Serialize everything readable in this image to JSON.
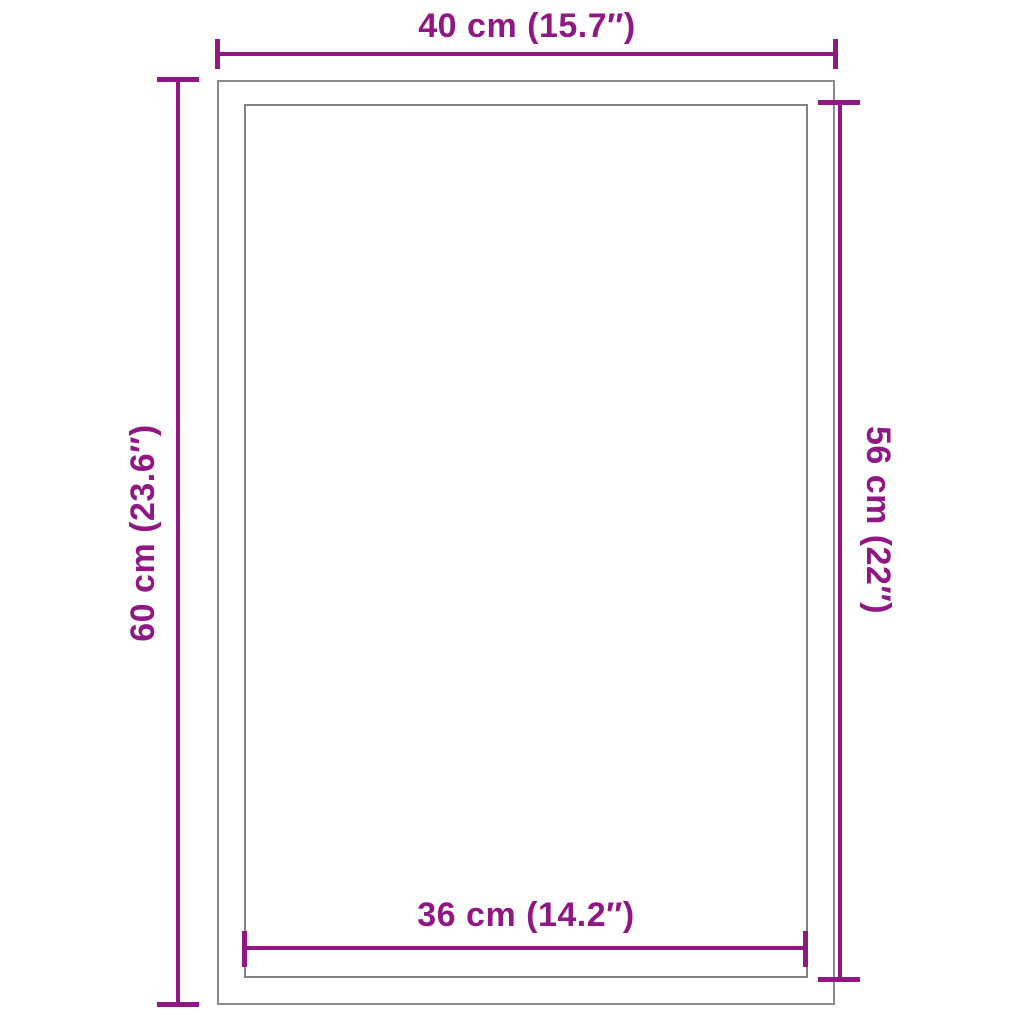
{
  "diagram": {
    "kind": "product-dimension-diagram",
    "background": "#ffffff",
    "colors": {
      "accent": "#911884",
      "outline_outer": "#8c8c8c",
      "outline_inner": "#828282"
    },
    "dimensions": {
      "top": {
        "label": "40 cm (15.7″)",
        "measures": "outer-width"
      },
      "left": {
        "label": "60 cm (23.6″)",
        "measures": "outer-height"
      },
      "right": {
        "label": "56 cm (22″)",
        "measures": "inner-height"
      },
      "bottom": {
        "label": "36 cm (14.2″)",
        "measures": "inner-width"
      }
    }
  }
}
